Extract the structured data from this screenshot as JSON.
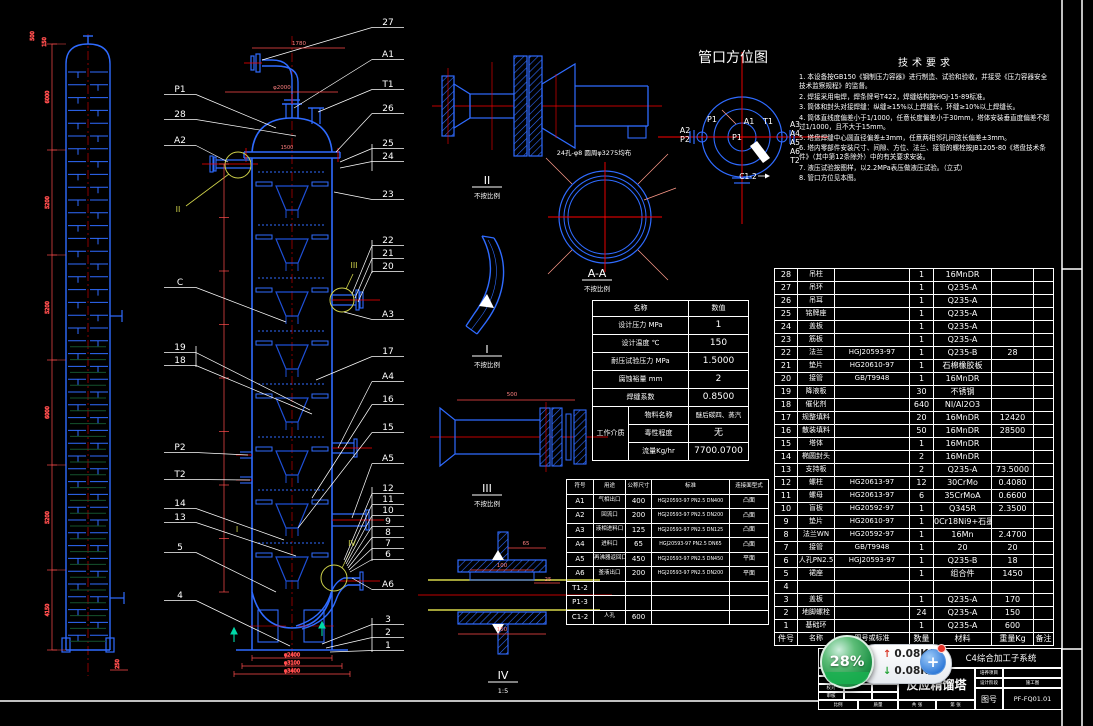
{
  "drawing": {
    "orientation": {
      "title": "管口方位图",
      "p1_outer": "P1",
      "a1": "A1",
      "t1": "T1",
      "a2": "A2",
      "p2": "P2",
      "p1_center": "P1",
      "right_stack": [
        "A3",
        "A4",
        "A5",
        "A6",
        "T2"
      ],
      "bottom": "C1-2"
    },
    "notes": {
      "title": "技术要求",
      "items": [
        "1. 本设备按GB150《钢制压力容器》进行制造、试验和验收，并接受《压力容器安全技术监察规程》的监督。",
        "2. 焊接采用电焊，焊条牌号T422，焊缝结构按HGJ-15-89标准。",
        "3. 筒体和封头对接焊缝：纵缝≥15%以上焊缝长，环缝≥10%以上焊缝长。",
        "4. 筒体直线度偏差小于1/1000，任意长度偏差小于30mm，塔体安装垂直度偏差不超过1/1000，且不大于15mm。",
        "5. 塔盘焊缝中心圆直径偏差±3mm，任意两相邻孔间弦长偏差±3mm。",
        "6. 塔内零部件安装尺寸、间隙、方位、法兰、接管的螺栓按JB1205-80《塔盘技术条件》（其中第12条除外）中的有关要求安装。",
        "7. 液压试验按图样，以2.2MPa表压做液压试验。（立式）",
        "8. 管口方位见本图。"
      ]
    },
    "details": [
      {
        "label": "II",
        "scale": "不按比例"
      },
      {
        "label": "A-A",
        "scale": "不按比例"
      },
      {
        "label": "I",
        "scale": "不按比例"
      },
      {
        "label": "III",
        "scale": "不按比例"
      },
      {
        "label": "IV",
        "scale": "1:5"
      }
    ],
    "markers": [
      "II",
      "III",
      "I",
      "IV"
    ],
    "holes_note": "24孔-φ8 圆周φ3275均布",
    "callouts": {
      "left": [
        "P1",
        "28",
        "A2",
        "C",
        "19",
        "18",
        "P2",
        "T2",
        "14",
        "13",
        "5",
        "4"
      ],
      "right": [
        "27",
        "A1",
        "T1",
        "26",
        "25",
        "24",
        "23",
        "22",
        "21",
        "20",
        "A3",
        "17",
        "A4",
        "16",
        "15",
        "A5",
        "12",
        "11",
        "10",
        "9",
        "8",
        "7",
        "6",
        "A6",
        "3",
        "2",
        "1"
      ]
    },
    "dims": {
      "top1": "1780",
      "top2": "φ2000",
      "mid": "1500",
      "base": [
        "φ2400",
        "φ3100",
        "φ3400"
      ],
      "left_top": [
        "500",
        "150"
      ],
      "left_chain": [
        "6000",
        "5200",
        "5200",
        "6000",
        "5200",
        "4150"
      ],
      "left_bottom": "250",
      "d3": "500",
      "d4": [
        "65",
        "100",
        "25",
        "150"
      ]
    }
  },
  "tech_table": {
    "header_name": "名称",
    "header_value": "数值",
    "rows": [
      {
        "label": "设计压力 MPa",
        "value": "1"
      },
      {
        "label": "设计温度 ℃",
        "value": "150"
      },
      {
        "label": "耐压试验压力 MPa",
        "value": "1.5000"
      },
      {
        "label": "腐蚀裕量 mm",
        "value": "2"
      },
      {
        "label": "焊缝系数",
        "value": "0.8500"
      }
    ],
    "medium": {
      "label": "工作介质",
      "rows": [
        {
          "label": "物料名称",
          "value": "醚后碳四、蒸汽"
        },
        {
          "label": "毒性程度",
          "value": "无"
        },
        {
          "label": "流量Kg/hr",
          "value": "7700.0700"
        }
      ]
    }
  },
  "nozzle_table": {
    "headers": [
      "符号",
      "用途",
      "公称尺寸",
      "标准",
      "连接面型式"
    ],
    "rows": [
      [
        "A1",
        "气相出口",
        "400",
        "HGJ20593-97 PN2.5 DN400",
        "凸面"
      ],
      [
        "A2",
        "回流口",
        "200",
        "HGJ20593-97 PN2.5 DN200",
        "凸面"
      ],
      [
        "A3",
        "液相进料口",
        "125",
        "HGJ20593-97 PN2.5 DN125",
        "凸面"
      ],
      [
        "A4",
        "进料口",
        "65",
        "HGJ20593-97 PN2.5 DN65",
        "凸面"
      ],
      [
        "A5",
        "再沸器返回口",
        "450",
        "HGJ20593-97 PN2.5 DN450",
        "平面"
      ],
      [
        "A6",
        "釜液出口",
        "200",
        "HGJ20593-97 PN2.5 DN200",
        "平面"
      ],
      [
        "T1-2",
        "",
        "",
        "",
        ""
      ],
      [
        "P1-3",
        "",
        "",
        "",
        ""
      ],
      [
        "C1-2",
        "人孔",
        "600",
        "",
        ""
      ]
    ]
  },
  "bom": {
    "rows": [
      [
        "28",
        "吊柱",
        "",
        "1",
        "16MnDR",
        "",
        ""
      ],
      [
        "27",
        "吊环",
        "",
        "1",
        "Q235-A",
        "",
        ""
      ],
      [
        "26",
        "吊耳",
        "",
        "1",
        "Q235-A",
        "",
        ""
      ],
      [
        "25",
        "铭牌座",
        "",
        "1",
        "Q235-A",
        "",
        ""
      ],
      [
        "24",
        "盖板",
        "",
        "1",
        "Q235-A",
        "",
        ""
      ],
      [
        "23",
        "筋板",
        "",
        "1",
        "Q235-A",
        "",
        ""
      ],
      [
        "22",
        "法兰",
        "HGJ20593-97",
        "1",
        "Q235-B",
        "28",
        ""
      ],
      [
        "21",
        "垫片",
        "HG20610-97",
        "1",
        "石棉橡胶板",
        "",
        ""
      ],
      [
        "20",
        "接管",
        "GB/T9948",
        "1",
        "16MnDR",
        "",
        ""
      ],
      [
        "19",
        "降液板",
        "",
        "30",
        "不锈钢",
        "",
        ""
      ],
      [
        "18",
        "催化剂",
        "",
        "640",
        "NI/Al2O3",
        "",
        ""
      ],
      [
        "17",
        "规整填料",
        "",
        "20",
        "16MnDR",
        "12420",
        ""
      ],
      [
        "16",
        "散装填料",
        "",
        "50",
        "16MnDR",
        "28500",
        ""
      ],
      [
        "15",
        "塔体",
        "",
        "1",
        "16MnDR",
        "",
        ""
      ],
      [
        "14",
        "椭圆封头",
        "",
        "2",
        "16MnDR",
        "",
        ""
      ],
      [
        "13",
        "支持板",
        "",
        "2",
        "Q235-A",
        "73.5000",
        ""
      ],
      [
        "12",
        "螺柱",
        "HG20613-97",
        "12",
        "30CrMo",
        "0.4080",
        ""
      ],
      [
        "11",
        "螺母",
        "HG20613-97",
        "6",
        "35CrMoA",
        "0.6600",
        ""
      ],
      [
        "10",
        "盲板",
        "HG20592-97",
        "1",
        "Q345R",
        "2.3500",
        ""
      ],
      [
        "9",
        "垫片",
        "HG20610-97",
        "1",
        "0Cr18Ni9+石墨",
        "",
        ""
      ],
      [
        "8",
        "法兰WN",
        "HG20592-97",
        "1",
        "16Mn",
        "2.4700",
        ""
      ],
      [
        "7",
        "接管",
        "GB/T9948",
        "1",
        "20",
        "20",
        ""
      ],
      [
        "6",
        "人孔PN2.5",
        "HGJ20593-97",
        "1",
        "Q235-B",
        "18",
        ""
      ],
      [
        "5",
        "裙座",
        "",
        "1",
        "组合件",
        "1450",
        ""
      ],
      [
        "4",
        "",
        "",
        "",
        "",
        "",
        ""
      ],
      [
        "3",
        "盖板",
        "",
        "1",
        "Q235-A",
        "170",
        ""
      ],
      [
        "2",
        "地脚螺栓",
        "",
        "24",
        "Q235-A",
        "150",
        ""
      ],
      [
        "1",
        "基础环",
        "",
        "1",
        "Q235-A",
        "600",
        ""
      ]
    ],
    "footer": [
      "件号",
      "名称",
      "图号或标准",
      "数量",
      "材料",
      "重量Kg",
      "备注"
    ]
  },
  "title_block": {
    "year": "2012年",
    "project": "C4综合加工子系统",
    "title": "反应精馏塔",
    "rows_left": [
      "设计",
      "制图",
      "校对",
      "审核"
    ],
    "field1_label": "培养项目",
    "field1_value": "",
    "field2_label": "设计阶段",
    "field2_value": "施工图",
    "dwg_no_label": "图号",
    "dwg_no": "PF-FQ01.01",
    "bottom": [
      "比例",
      "质量",
      "共 张",
      "第 张"
    ]
  },
  "widget": {
    "progress": "28%",
    "upload": "0.08K/s",
    "download": "0.08K/s",
    "plus": "+"
  }
}
